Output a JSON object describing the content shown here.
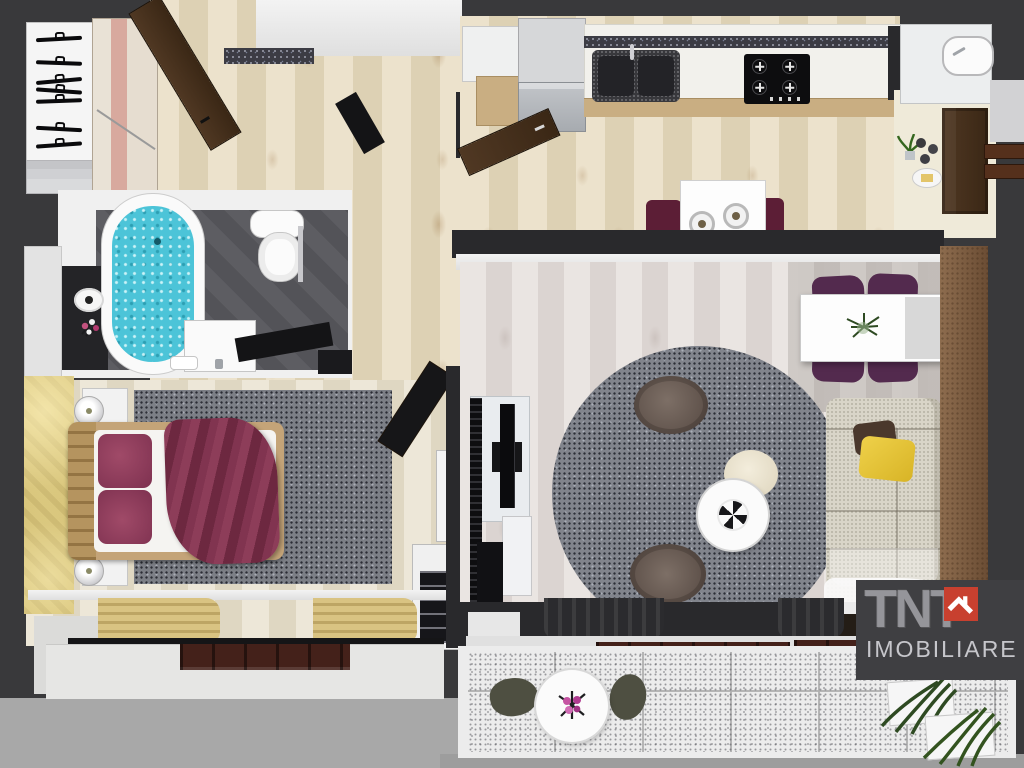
{
  "watermark": {
    "brand": "TNT",
    "word": "IMOBILIARE",
    "house_icon": "house-in-red-square",
    "block_color": "#3f3f42",
    "roof_color": "#c8402f",
    "text_color": "#cacad0"
  },
  "palette": {
    "outside_dark": "#39393b",
    "outside_light": "#a8a8a8",
    "wall_face_white": "#ebebeb",
    "hall_parquet_beige": "#e5d9bd",
    "living_floor_whitewash": "#e6e1de",
    "bedroom_floor_beige": "#eae3d2",
    "bath_tile_dark": "#56565b",
    "bath_water_turquoise": "#4cc4d8",
    "rug_gray": "#7c7f86",
    "bed_blanket_burgundy": "#7c2f49",
    "bed_pillow_burgundy": "#8c3a55",
    "bed_frame_tan": "#c4a478",
    "accent_wall_yellow": "#cfba6b",
    "accent_wall_brown": "#84664a",
    "dining_chair_purple": "#532a4e",
    "kitchen_chair_maroon": "#5c1e36",
    "sofa_beige": "#d9d5c8",
    "sofa_pillow_yellow": "#e4c134",
    "door_wood_brown": "#4a3222",
    "balcony_tile": "#ececec",
    "plant_green": "#33531f"
  },
  "rooms": [
    {
      "name": "hallway",
      "furniture": [
        "open-wardrobe-with-hangers",
        "wardrobe-cabinet",
        "entry-door-open",
        "glitter-doormat",
        "console-table"
      ]
    },
    {
      "name": "kitchen",
      "furniture": [
        "fridge",
        "upper-cabinet",
        "counter-run",
        "double-granite-sink",
        "gas-cooktop",
        "kitchen-door-open",
        "breakfast-table",
        "two-plates",
        "two-maroon-chairs"
      ]
    },
    {
      "name": "entry-nook",
      "furniture": [
        "cabinet-with-washbasin",
        "potted-plant",
        "snack-tray",
        "front-door",
        "coat-rails"
      ]
    },
    {
      "name": "bathroom",
      "furniture": [
        "bathtub-with-water",
        "toilet",
        "towel-rail",
        "washbasin-vanity",
        "toilet-paper-holder",
        "flower-decor",
        "bathroom-door-open"
      ]
    },
    {
      "name": "bedroom",
      "furniture": [
        "yellow-accent-wall",
        "double-bed",
        "burgundy-pillows",
        "burgundy-blanket",
        "nightstands-with-lamps",
        "gray-rug",
        "bedroom-door-open",
        "dresser",
        "desk-with-chair",
        "window-with-tan-curtains"
      ]
    },
    {
      "name": "living-room",
      "furniture": [
        "media-wall-with-tv",
        "round-shag-rug",
        "two-poufs",
        "round-coffee-table",
        "cream-ottoman",
        "sofa",
        "yellow-cushion",
        "dining-table",
        "four-purple-chairs",
        "centerpiece-plant",
        "brown-accent-wall",
        "sheer-curtain"
      ]
    },
    {
      "name": "balcony",
      "furniture": [
        "dark-curtains",
        "window-sill",
        "wood-threshold-benches",
        "bistro-table",
        "flower-vase",
        "two-olive-chairs",
        "planter-boxes-with-plants"
      ]
    }
  ]
}
